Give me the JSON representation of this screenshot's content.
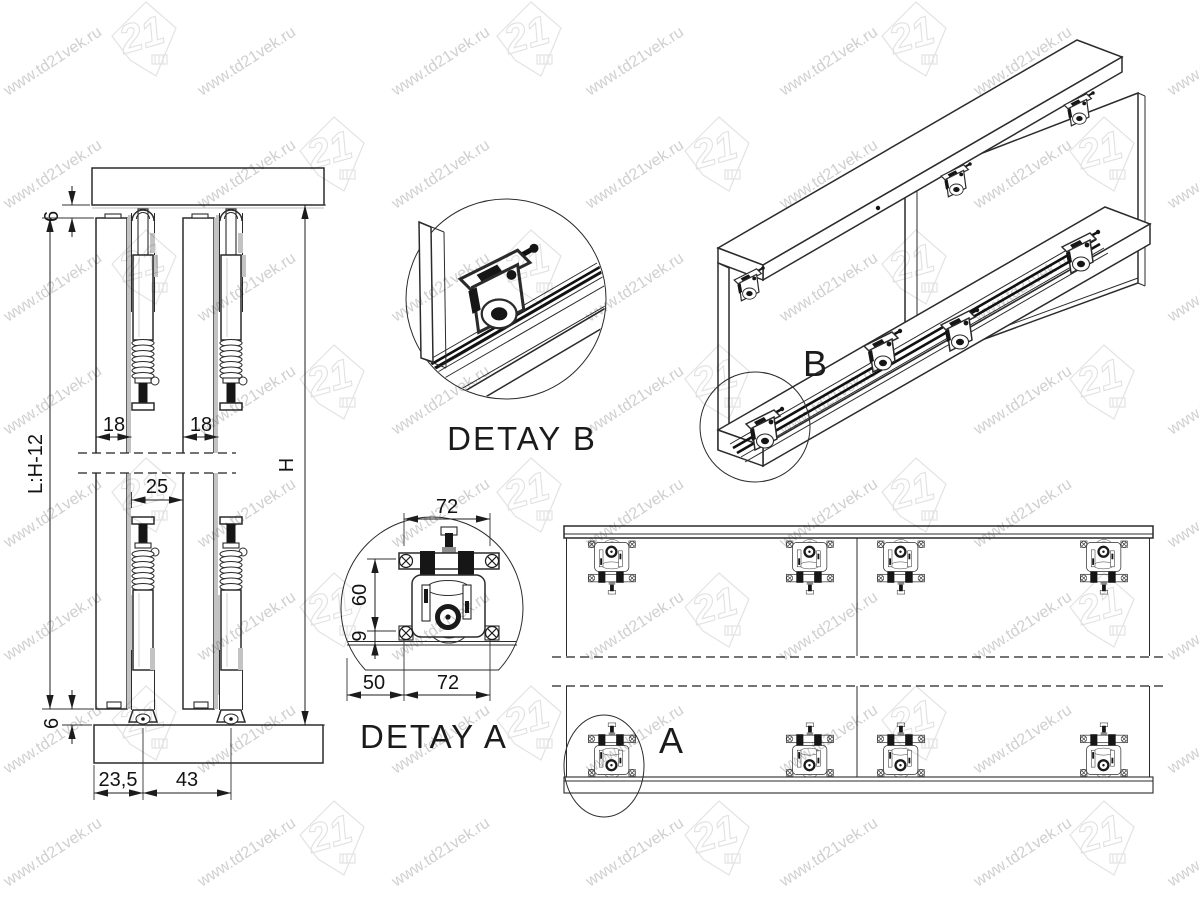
{
  "drawing_title": "Sliding door roller system - assembly drawing",
  "watermark": {
    "url": "www.td21vek.ru",
    "logo_text": "21"
  },
  "colors": {
    "line": "#2b2b2b",
    "dim_text": "#131313",
    "watermark_text": "#c7c7c7",
    "watermark_logo": "#e0e0e0",
    "metal_dark": "#161616",
    "shade_gray": "#c3c3c3"
  },
  "section_view": {
    "dims": {
      "top_gap": "6",
      "hanger_offset_left": "18",
      "hanger_offset_right": "18",
      "door_gap": "25",
      "door_height": "L:H-12",
      "opening_height": "H",
      "bottom_gap": "6",
      "bottom_edge_offset": "23,5",
      "bottom_spacing": "43"
    }
  },
  "detail_a": {
    "label": "DETAY A",
    "dims": {
      "plate_width": "72",
      "body_height": "60",
      "rail_offset": "9",
      "edge_offset": "50",
      "base_width": "72"
    }
  },
  "detail_b": {
    "label": "DETAY B"
  },
  "iso_view": {
    "marker": "B"
  },
  "front_view": {
    "marker": "A"
  }
}
